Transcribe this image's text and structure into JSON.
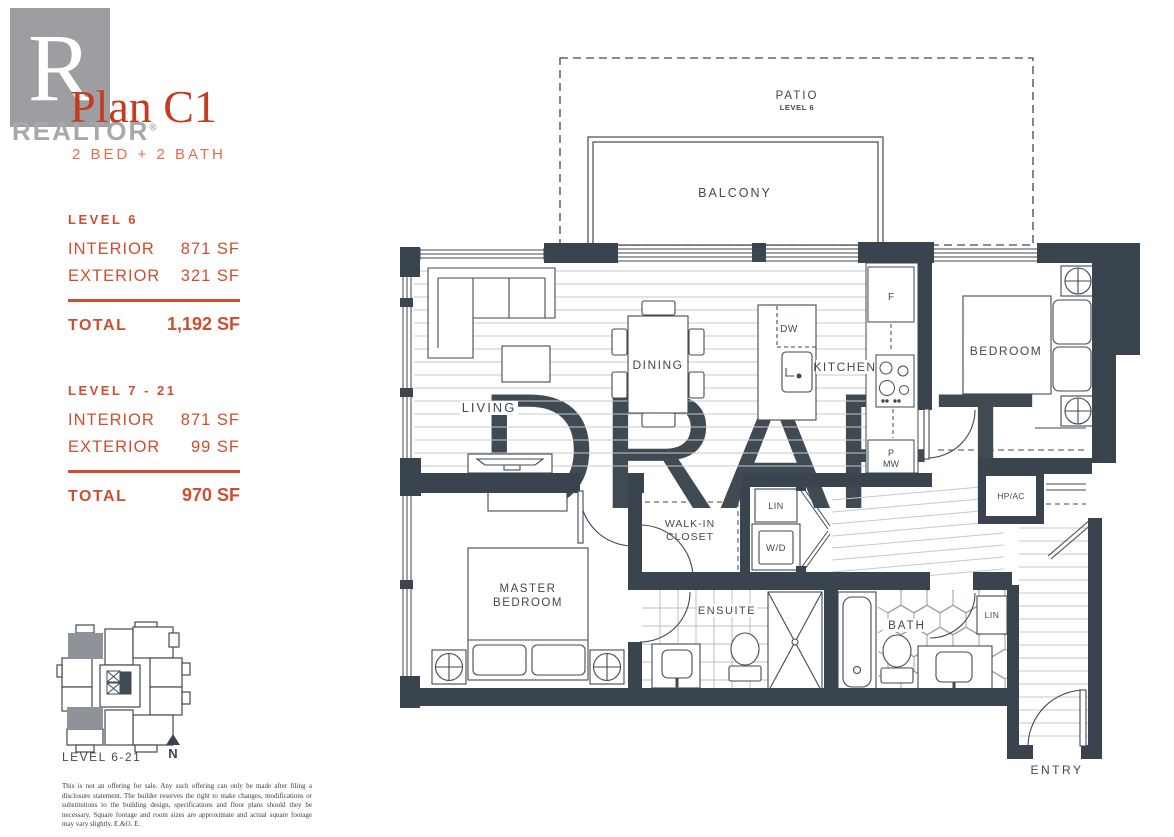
{
  "header": {
    "logo_letter": "R",
    "logo_word": "REALTOR",
    "logo_reg": "®",
    "title": "Plan C1",
    "subtitle": "2 BED + 2 BATH"
  },
  "stats": [
    {
      "level": "LEVEL 6",
      "rows": [
        {
          "label": "INTERIOR",
          "value": "871 SF"
        },
        {
          "label": "EXTERIOR",
          "value": "321 SF"
        }
      ],
      "total_label": "TOTAL",
      "total_value": "1,192 SF"
    },
    {
      "level": "LEVEL 7 - 21",
      "rows": [
        {
          "label": "INTERIOR",
          "value": "871 SF"
        },
        {
          "label": "EXTERIOR",
          "value": "99 SF"
        }
      ],
      "total_label": "TOTAL",
      "total_value": "970 SF"
    }
  ],
  "keyplan": {
    "label": "LEVEL 6-21",
    "north_label": "N"
  },
  "plan": {
    "watermark": "DRAFT",
    "labels": {
      "patio": "PATIO",
      "patio_level": "LEVEL 6",
      "balcony": "BALCONY",
      "living": "LIVING",
      "dining": "DINING",
      "kitchen": "KITCHEN",
      "bedroom": "BEDROOM",
      "master_line1": "MASTER",
      "master_line2": "BEDROOM",
      "walkin_line1": "WALK-IN",
      "walkin_line2": "CLOSET",
      "ensuite": "ENSUITE",
      "bath": "BATH",
      "entry": "ENTRY",
      "lin_hall": "LIN",
      "lin_bath": "LIN",
      "wd": "W/D",
      "hpac": "HP/AC",
      "fridge": "F",
      "dishwasher": "DW",
      "pantry_line1": "P",
      "pantry_line2": "MW"
    }
  },
  "disclaimer": "This is not an offering for sale. Any such offering can only be made after filing a disclosure statement. The builder reserves the right to make changes, modifications or substitutions to the building design, specifications and floor plans should they be necessary. Square footage and room sizes are approximate and actual square footage may vary slightly. E.&O. E.",
  "colors": {
    "accent": "#cd4f30",
    "title_red": "#c43b1f",
    "wall": "#3a444e",
    "watermark": "#ece4d5",
    "keyplan_highlight": "#8d9399",
    "logo_gray": "#9c9ea1"
  }
}
